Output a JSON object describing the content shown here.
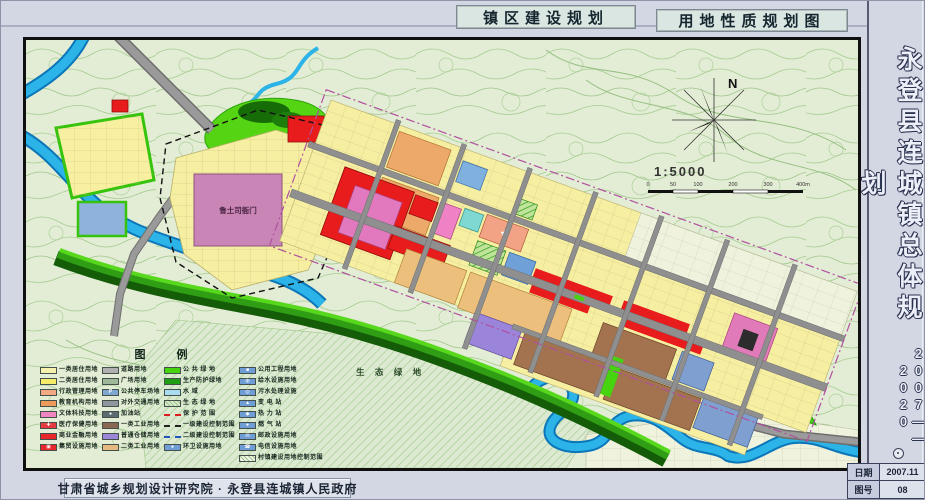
{
  "header": {
    "title_left": "镇区建设规划",
    "title_right": "用地性质规划图"
  },
  "sidebar": {
    "title": "永登县连城镇总体规划",
    "years": "2007——2020",
    "date_label": "日期",
    "date_value": "2007.11",
    "sheet_label": "图号",
    "sheet_value": "08"
  },
  "footer": {
    "credits": "甘肃省城乡规划设计研究院 · 永登县连城镇人民政府"
  },
  "map": {
    "annotations": {
      "historic_site": "鲁土司衙门",
      "eco_green": "生 态 绿 地"
    },
    "compass": {
      "north_label": "N",
      "scale_text": "1:5000",
      "scale_ticks": [
        "0",
        "50",
        "100",
        "200",
        "300",
        "400m"
      ]
    }
  },
  "legend": {
    "title": "图  例",
    "columns": [
      {
        "items": [
          {
            "label": "一类居住用地",
            "color": "#f7f1ae",
            "kind": "fill"
          },
          {
            "label": "二类居住用地",
            "color": "#f5ec6a",
            "kind": "fill"
          },
          {
            "label": "行政管理用地",
            "color": "#f2a883",
            "kind": "fill"
          },
          {
            "label": "教育机构用地",
            "color": "#ec9b5a",
            "kind": "fill"
          },
          {
            "label": "文体科技用地",
            "color": "#ef86c0",
            "kind": "fill"
          },
          {
            "label": "医疗保健用地",
            "color": "#e43a40",
            "kind": "sym",
            "glyph": "✚"
          },
          {
            "label": "商业金融用地",
            "color": "#e8262c",
            "kind": "fill"
          },
          {
            "label": "集贸设施用地",
            "color": "#e8262c",
            "kind": "sym",
            "glyph": "▣"
          }
        ]
      },
      {
        "items": [
          {
            "label": "道路用地",
            "color": "#b0b0b0",
            "kind": "fill"
          },
          {
            "label": "广场用地",
            "color": "#9fb89a",
            "kind": "fill"
          },
          {
            "label": "公共停车场地",
            "color": "#7fa8d0",
            "kind": "sym",
            "glyph": "P"
          },
          {
            "label": "对外交通用地",
            "color": "#8f979e",
            "kind": "fill"
          },
          {
            "label": "加油站",
            "color": "#5c6a72",
            "kind": "sym",
            "glyph": "●"
          },
          {
            "label": "一类工业用地",
            "color": "#8a6753",
            "kind": "fill"
          },
          {
            "label": "普通仓储用地",
            "color": "#9b86d8",
            "kind": "fill"
          },
          {
            "label": "二类工业用地",
            "color": "#e5b97f",
            "kind": "fill"
          }
        ]
      },
      {
        "items": [
          {
            "label": "公 共 绿 地",
            "color": "#45d40e",
            "kind": "fill"
          },
          {
            "label": "生产防护绿地",
            "color": "#1e9e14",
            "kind": "fill"
          },
          {
            "label": "水  域",
            "color": "#a8dcee",
            "kind": "fill"
          },
          {
            "label": "生 态 绿 地",
            "color": "#dcead2",
            "kind": "hatch"
          },
          {
            "label": "保 护 范 围",
            "color": "#d81e1e",
            "kind": "line"
          },
          {
            "label": "一级建设控制范围",
            "color": "#222222",
            "kind": "line"
          },
          {
            "label": "二级建设控制范围",
            "color": "#2255bb",
            "kind": "line"
          },
          {
            "label": "环卫设施用地",
            "color": "#6f9ed6",
            "kind": "sym",
            "glyph": "●"
          }
        ]
      },
      {
        "items": [
          {
            "label": "公用工程用地",
            "color": "#6f9ed6",
            "kind": "sym",
            "glyph": "■"
          },
          {
            "label": "给水设施用地",
            "color": "#6f9ed6",
            "kind": "sym",
            "glyph": "◍"
          },
          {
            "label": "污水处理设施",
            "color": "#6f9ed6",
            "kind": "sym",
            "glyph": "◎"
          },
          {
            "label": "变 电 站",
            "color": "#6f9ed6",
            "kind": "sym",
            "glyph": "▲"
          },
          {
            "label": "热 力 站",
            "color": "#6f9ed6",
            "kind": "sym",
            "glyph": "◆"
          },
          {
            "label": "燃 气 站",
            "color": "#6f9ed6",
            "kind": "sym",
            "glyph": "●"
          },
          {
            "label": "邮政设施用地",
            "color": "#6f9ed6",
            "kind": "sym",
            "glyph": "✉"
          },
          {
            "label": "电信设施用地",
            "color": "#6f9ed6",
            "kind": "sym",
            "glyph": "☎"
          },
          {
            "label": "村镇建设用地控制范围",
            "color": "#f4f6ee",
            "kind": "hatch"
          }
        ]
      }
    ]
  },
  "palette": {
    "topo_background": "#e3ecd4",
    "contour_line": "#a5cd92",
    "water": "#2cb4e8",
    "water_edge": "#0b76b8",
    "public_green": "#45d40e",
    "protect_green": "#1e9e14",
    "residential_yellow": "#f6efa2",
    "commercial_red": "#e81c1c",
    "culture_pink": "#e279be",
    "education_orange": "#eda96a",
    "industry_brown": "#a3734f",
    "industry_tan": "#ecc07c",
    "storage_purple": "#9b85da",
    "utility_blue": "#7f9fd0",
    "historic_mauve": "#c985b5",
    "road_gray": "#8f8f8f",
    "sheet_background": "#d3d6e3"
  }
}
